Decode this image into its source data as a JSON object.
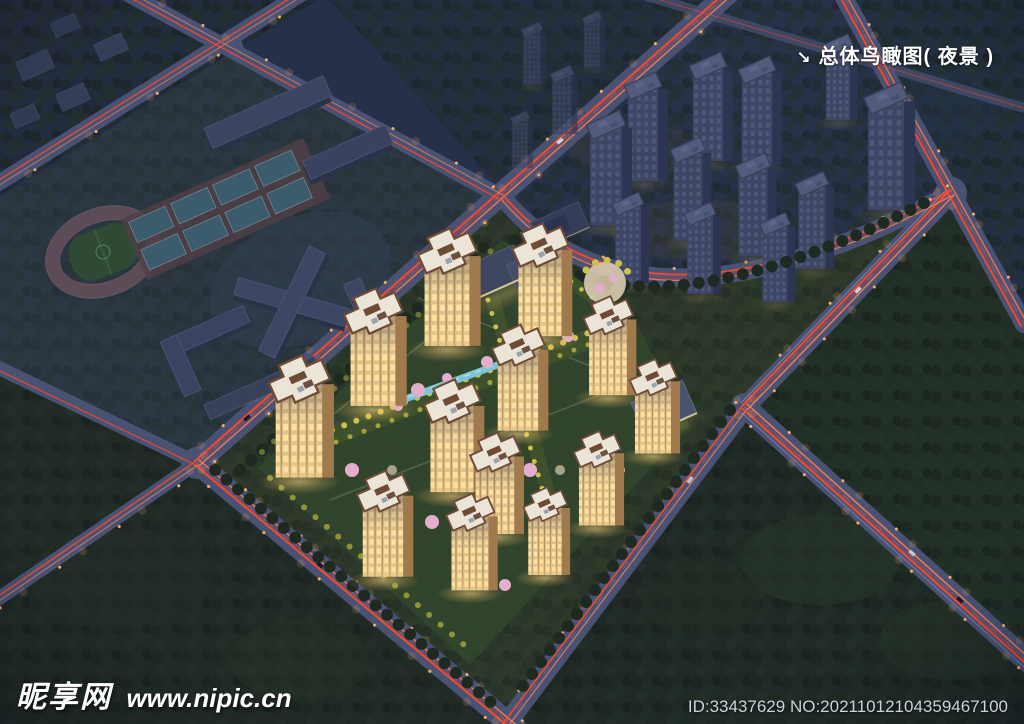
{
  "canvas": {
    "width": 1024,
    "height": 724
  },
  "overlay": {
    "title": {
      "arrow": "↘",
      "label": "总体鸟瞰图( 夜景 )"
    },
    "watermark": {
      "site_name": "昵享网",
      "site_url": "www.nipic.cn"
    },
    "footer_id": "ID:33437629 NO:20211012104359467100"
  },
  "palette": {
    "night_sky": "#273049",
    "forest_blue": "#232c3e",
    "forest_green": "#1f2a24",
    "road": "#4a5274",
    "road_line": "#6d76a0",
    "light_trail": "#ff4a28",
    "light_trail_soft": "#ff8a5c",
    "street_lamp": "#ffb066",
    "lit_facade": "#dfc28a",
    "lit_window": "#ffe2a0",
    "lit_roof": "#ebe5d8",
    "roof_trim": "#6f4b36",
    "dim_face": "#3e4663",
    "dim_roof": "#525b7c",
    "garden_yellow": "#cbc14e",
    "blossom_pink": "#e3aecb",
    "water": "#7ec4d6",
    "lawn": "#31452c",
    "track": "#5c4c58",
    "field": "#2e4a34",
    "court": "#3b5c6d"
  },
  "scene": {
    "lit_towers": 13,
    "dim_towers": 12,
    "faint_towers": 4,
    "running_track": 1,
    "sport_courts": 8,
    "entrance_plaza": 1
  }
}
